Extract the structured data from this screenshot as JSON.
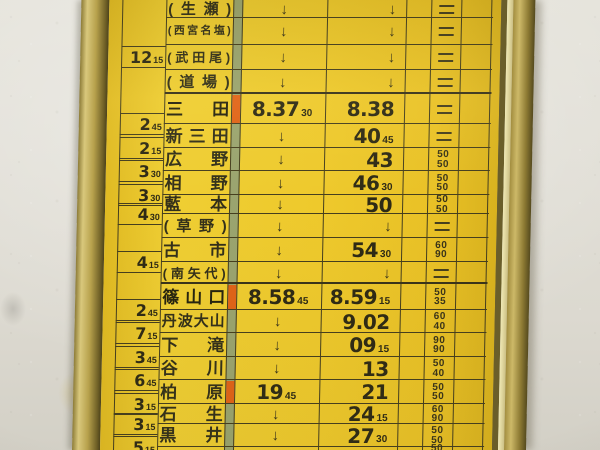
{
  "timetable": {
    "symbols": {
      "pass_arrow": "↓",
      "no_stop_mark": "="
    },
    "colors": {
      "card_yellow": "#eec92c",
      "strip_green": "#9aa46f",
      "stop_mark_orange": "#e06318",
      "frame_gold": "#b7a14c",
      "wall_white": "#dfddd5",
      "ink": "#2e2a15"
    },
    "rows": [
      {
        "rt": "",
        "name": "(生瀬)",
        "bold": false,
        "arr": "↓",
        "dep": "↓",
        "spd": "=",
        "mark": false
      },
      {
        "rt": "",
        "name": "(西宮名塩)",
        "bold": false,
        "arr": "↓",
        "dep": "↓",
        "spd": "=",
        "mark": false
      },
      {
        "rt": "12|15",
        "name": "(武田尾)",
        "bold": false,
        "arr": "↓",
        "dep": "↓",
        "spd": "=",
        "mark": false
      },
      {
        "rt": "",
        "name": "(道場)",
        "bold": false,
        "arr": "↓",
        "dep": "↓",
        "spd": "=",
        "mark": false
      },
      {
        "rt": "",
        "name": "三田",
        "bold": true,
        "arr": "8.37|30",
        "dep": "8.38",
        "spd": "=",
        "mark": true
      },
      {
        "rt": "2|45",
        "name": "新三田",
        "bold": false,
        "arr": "↓",
        "dep": "40|45",
        "spd": "=",
        "mark": false
      },
      {
        "rt": "2|15",
        "name": "広野",
        "bold": false,
        "arr": "↓",
        "dep": "43",
        "spd": "50/50",
        "mark": false
      },
      {
        "rt": "3|30",
        "name": "相野",
        "bold": false,
        "arr": "↓",
        "dep": "46|30",
        "spd": "50/50",
        "mark": false
      },
      {
        "rt": "3|30",
        "name": "藍本",
        "bold": false,
        "arr": "↓",
        "dep": "50",
        "spd": "50/50",
        "mark": false
      },
      {
        "rt": "4|30",
        "name": "(草野)",
        "bold": false,
        "arr": "↓",
        "dep": "↓",
        "spd": "=",
        "mark": false
      },
      {
        "rt": "",
        "name": "古市",
        "bold": false,
        "arr": "↓",
        "dep": "54|30",
        "spd": "60/90",
        "mark": false
      },
      {
        "rt": "4|15",
        "name": "(南矢代)",
        "bold": false,
        "arr": "↓",
        "dep": "↓",
        "spd": "=",
        "mark": false
      },
      {
        "rt": "",
        "name": "篠山口",
        "bold": true,
        "arr": "8.58|45",
        "dep": "8.59|15",
        "spd": "50/35",
        "mark": true
      },
      {
        "rt": "2|45",
        "name": "丹波大山",
        "bold": false,
        "arr": "↓",
        "dep": "9.02",
        "spd": "60/40",
        "mark": false
      },
      {
        "rt": "7|15",
        "name": "下滝",
        "bold": false,
        "arr": "↓",
        "dep": "09|15",
        "spd": "90/90",
        "mark": false
      },
      {
        "rt": "3|45",
        "name": "谷川",
        "bold": false,
        "arr": "↓",
        "dep": "13",
        "spd": "50/40",
        "mark": false
      },
      {
        "rt": "6|45",
        "name": "柏原",
        "bold": false,
        "arr": "19|45",
        "dep": "21",
        "spd": "50/50",
        "mark": true
      },
      {
        "rt": "3|15",
        "name": "石生",
        "bold": false,
        "arr": "↓",
        "dep": "24|15",
        "spd": "60/90",
        "mark": false
      },
      {
        "rt": "3|15",
        "name": "黒井",
        "bold": false,
        "arr": "↓",
        "dep": "27|30",
        "spd": "50/50",
        "mark": false
      },
      {
        "rt": "5|15",
        "name": "",
        "bold": false,
        "arr": "",
        "dep": "",
        "spd": "50/",
        "mark": false
      }
    ]
  }
}
